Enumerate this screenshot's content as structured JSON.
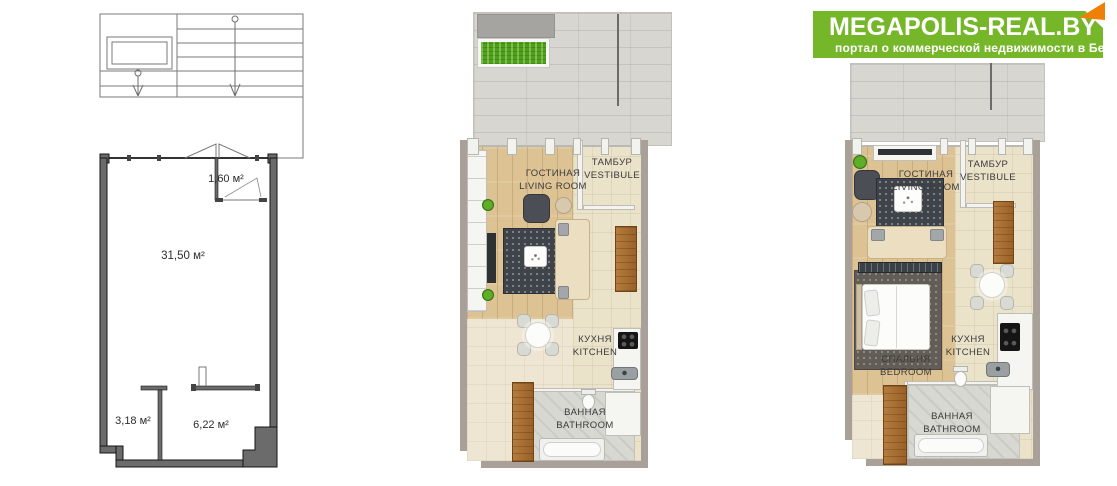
{
  "logo": {
    "title": "MEGAPOLIS-REAL.BY",
    "subtitle": "портал о коммерческой недвижимости в Беларуси",
    "brand_green": "#76b72a",
    "brand_orange": "#f07f05"
  },
  "technical_plan": {
    "vestibule_area": "1,60 м²",
    "main_area": "31,50 м²",
    "bathroom_area": "3,18 м²",
    "hall_area": "6,22 м²"
  },
  "studio_plan": {
    "living_ru": "ГОСТИНАЯ",
    "living_en": "LIVING ROOM",
    "vestibule_ru": "ТАМБУР",
    "vestibule_en": "VESTIBULE",
    "kitchen_ru": "КУХНЯ",
    "kitchen_en": "KITCHEN",
    "bath_ru": "ВАННАЯ",
    "bath_en": "BATHROOM"
  },
  "bedroom_plan": {
    "living_ru": "ГОСТИНАЯ",
    "living_en": "LIVING ROOM",
    "vestibule_ru": "ТАМБУР",
    "vestibule_en": "VESTIBULE",
    "bedroom_ru": "СПАЛЬНЯ",
    "bedroom_en": "BEDROOM",
    "kitchen_ru": "КУХНЯ",
    "kitchen_en": "KITCHEN",
    "bath_ru": "ВАННАЯ",
    "bath_en": "BATHROOM"
  }
}
